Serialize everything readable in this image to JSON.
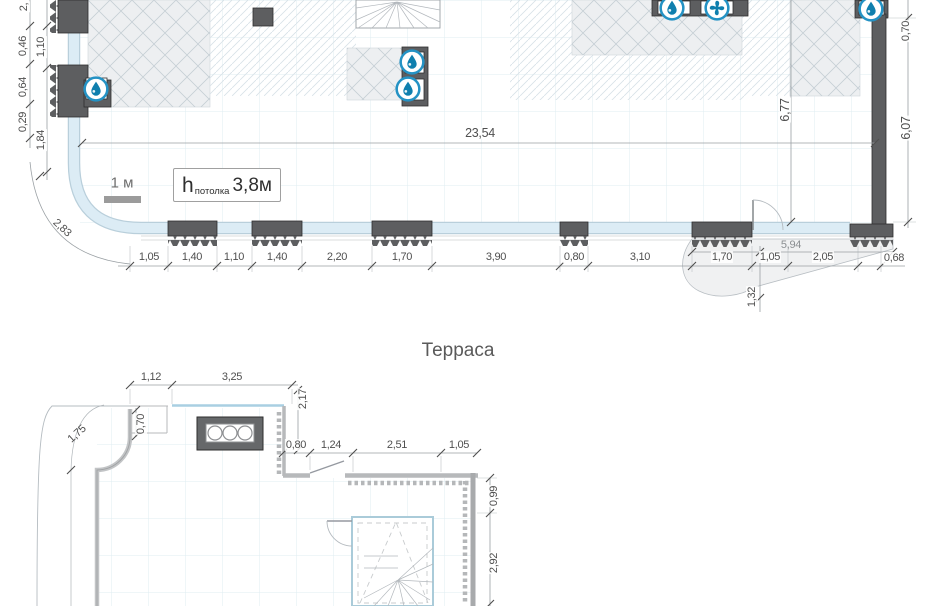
{
  "colors": {
    "wall": "#5d5e60",
    "glazing": "#dcecf5",
    "accent_blue": "#2492c4",
    "drop_blue": "#0f7fae",
    "hatch_bg": "#edeff1",
    "dim_text": "#4f4f4f"
  },
  "upper_plan": {
    "scale_bar": {
      "label": "1 м"
    },
    "ceiling": {
      "symbol": "h",
      "subscript": "потолка",
      "value": "3,8м"
    },
    "icons": {
      "water": "water-drop-icon",
      "fan": "fan-icon"
    },
    "dims": {
      "overall_width": "23,54",
      "interior_depth": "6,77",
      "right_chain": [
        "0,70",
        "6,07"
      ],
      "left_outer_chain": [
        "2,",
        "0,46",
        "0,64",
        "0,29"
      ],
      "left_inner_chain": [
        "1,10",
        "1,84"
      ],
      "corner_diagonal": "2,83",
      "bottom_chain": [
        "1,05",
        "1,40",
        "1,10",
        "1,40",
        "2,20",
        "1,70",
        "3,90",
        "0,80",
        "3,10",
        "1,70",
        "1,05",
        "2,05",
        "0,68"
      ],
      "entry_width": "5,94",
      "entry_depth": "1,32"
    }
  },
  "lower_plan": {
    "title": "Терраса",
    "dims": {
      "top_chain": [
        "1,12",
        "3,25"
      ],
      "left_step": "0,70",
      "corner_diagonal": "1,75",
      "right_offset": "2,17",
      "inner_chain": [
        "0,80",
        "1,24",
        "2,51",
        "1,05"
      ],
      "right_chain": [
        "0,99",
        "2,92"
      ]
    }
  }
}
